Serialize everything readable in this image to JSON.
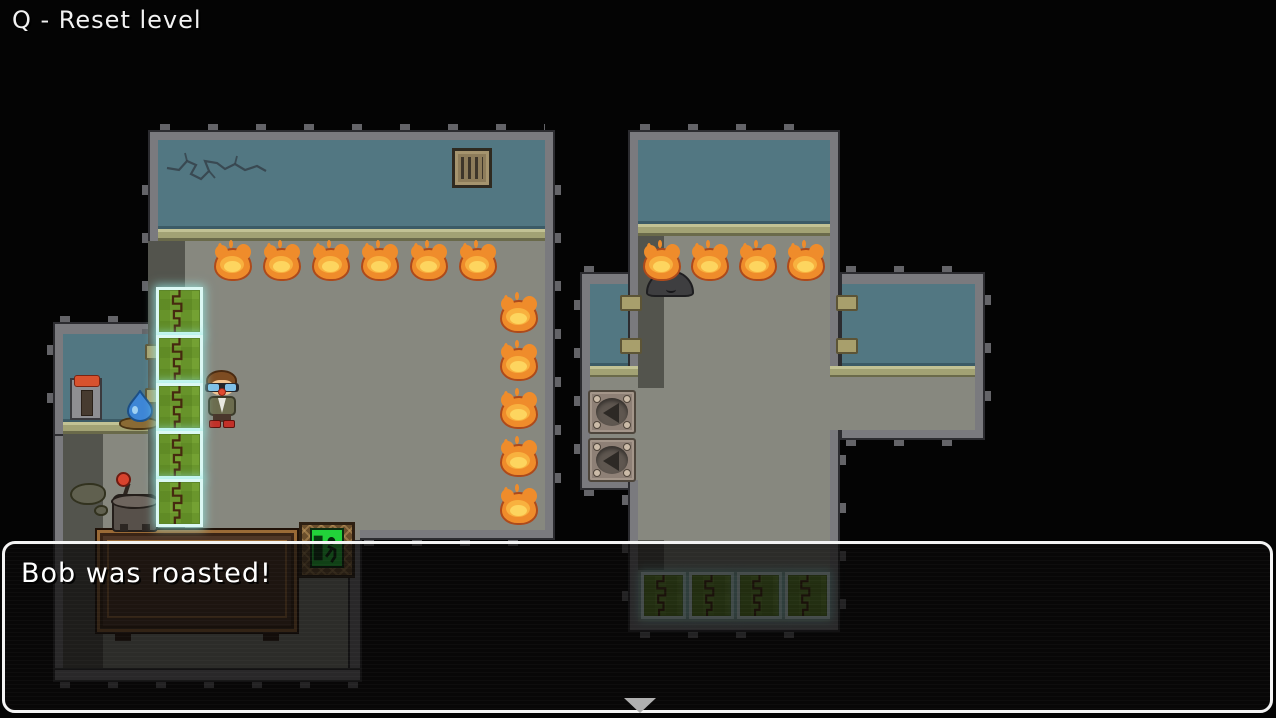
{
  "hud": {
    "reset_hint": "Q - Reset level"
  },
  "dialog": {
    "text": "Bob was roasted!",
    "continue_indicator": "down-triangle"
  },
  "level": {
    "player": {
      "name": "Bob",
      "x": 204,
      "y": 370,
      "status": "standing"
    },
    "roasted_player": {
      "x": 646,
      "y": 270,
      "status": "roasted"
    },
    "fires": [
      {
        "x": 212,
        "y": 243
      },
      {
        "x": 261,
        "y": 243
      },
      {
        "x": 310,
        "y": 243
      },
      {
        "x": 359,
        "y": 243
      },
      {
        "x": 408,
        "y": 243
      },
      {
        "x": 457,
        "y": 243
      },
      {
        "x": 498,
        "y": 295
      },
      {
        "x": 498,
        "y": 343
      },
      {
        "x": 498,
        "y": 391
      },
      {
        "x": 498,
        "y": 439
      },
      {
        "x": 498,
        "y": 487
      },
      {
        "x": 641,
        "y": 243
      },
      {
        "x": 689,
        "y": 243
      },
      {
        "x": 737,
        "y": 243
      },
      {
        "x": 785,
        "y": 243
      }
    ],
    "hedges": [
      {
        "group": "column",
        "x": 156,
        "y": 287
      },
      {
        "group": "column",
        "x": 156,
        "y": 335
      },
      {
        "group": "column",
        "x": 156,
        "y": 383
      },
      {
        "group": "column",
        "x": 156,
        "y": 431
      },
      {
        "group": "column",
        "x": 156,
        "y": 479
      },
      {
        "group": "row",
        "x": 641,
        "y": 572
      },
      {
        "group": "row",
        "x": 689,
        "y": 572
      },
      {
        "group": "row",
        "x": 737,
        "y": 572
      },
      {
        "group": "row",
        "x": 785,
        "y": 572
      }
    ],
    "arrow_pads": [
      {
        "x": 588,
        "y": 390,
        "direction": "left"
      },
      {
        "x": 588,
        "y": 438,
        "direction": "left"
      }
    ]
  },
  "colors": {
    "background": "#040404",
    "wall": "#7a7a7e",
    "wall_tick": "#646468",
    "teal_wall": "#527782",
    "baseboard": "#a2a274",
    "floor": "#87887f",
    "shadow": "#53544d",
    "hedge_green": "#74a133",
    "hedge_glow": "#dbf8f4",
    "fire_body": "#ef8c2b",
    "fire_mid": "#f8b13f",
    "fire_core": "#fdd55f",
    "dialog_border": "#f4f4f4",
    "table_brown": "#4f3626",
    "exit_green": "#22d23a",
    "lever_red": "#d8522e",
    "water_blue": "#3e86d6"
  }
}
